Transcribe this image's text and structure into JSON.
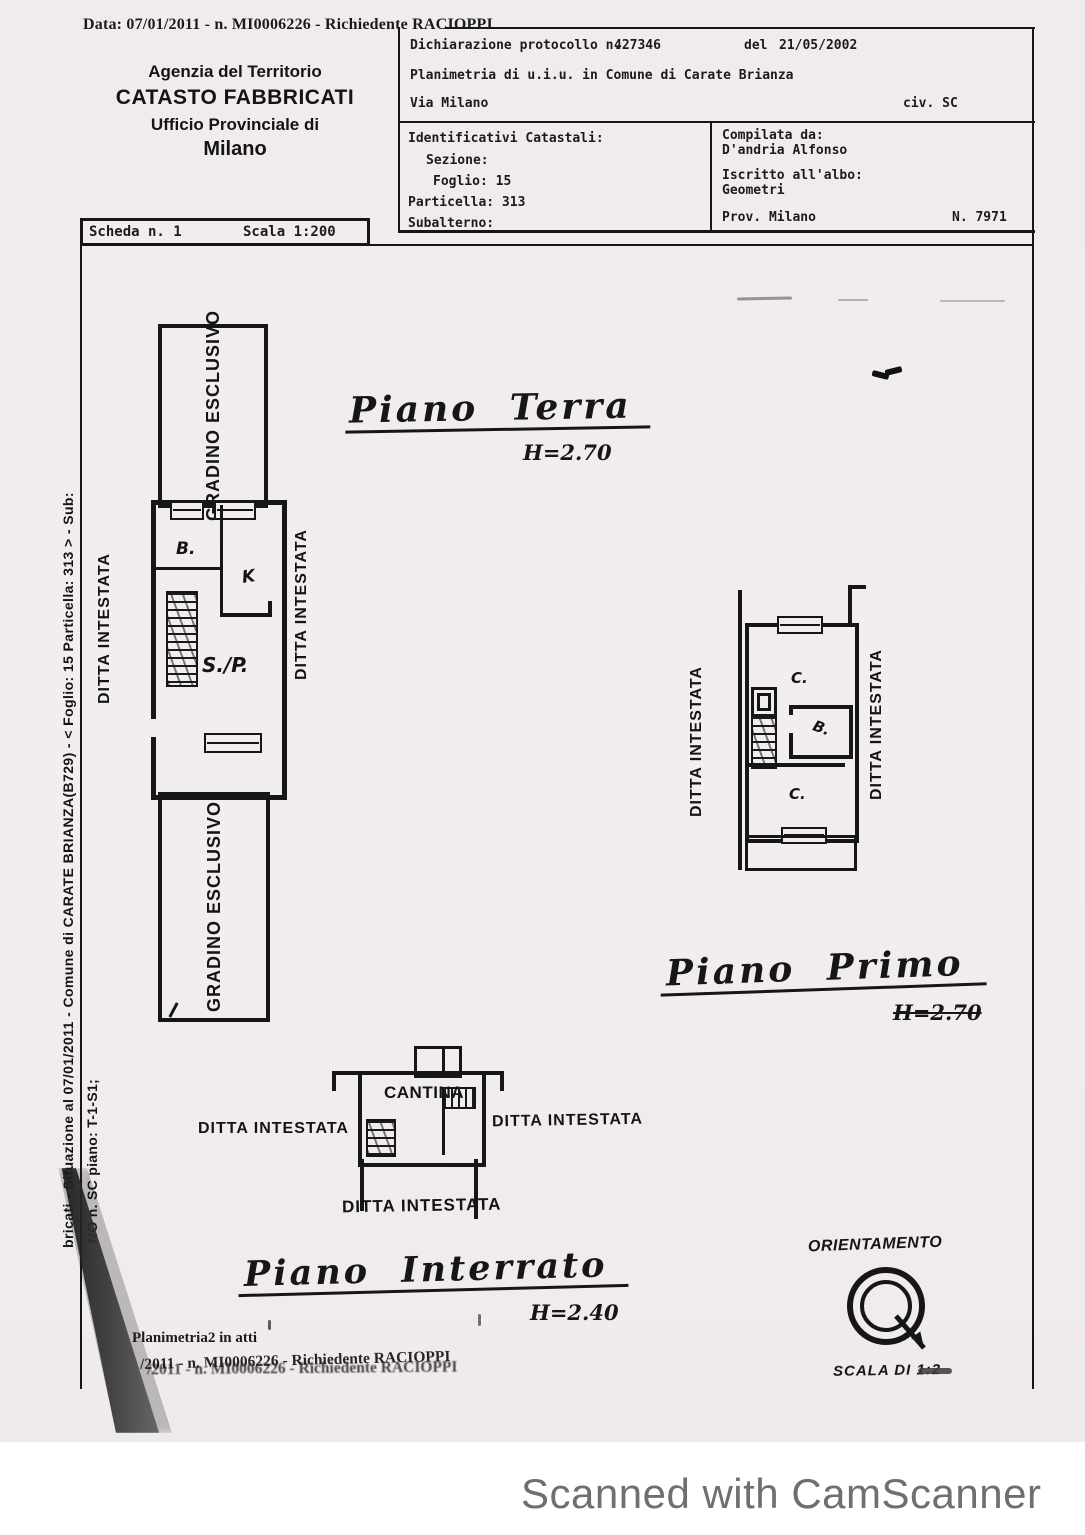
{
  "header": {
    "data_line": "Data: 07/01/2011 - n. MI0006226 - Richiedente RACIOPPI",
    "agency_line1": "Agenzia del Territorio",
    "agency_line2": "CATASTO FABBRICATI",
    "agency_line3": "Ufficio Provinciale di",
    "agency_line4": "Milano",
    "protocol_label": "Dichiarazione protocollo n.",
    "protocol_number": "427346",
    "protocol_del": "del",
    "protocol_date": "21/05/2002",
    "planimetria_line": "Planimetria di u.i.u. in Comune di Carate Brianza",
    "via": "Via Milano",
    "civ": "civ. SC",
    "identificativi_title": "Identificativi Catastali:",
    "sezione": "Sezione:",
    "foglio": "Foglio: 15",
    "particella": "Particella: 313",
    "subalterno": "Subalterno:",
    "compilata_title": "Compilata da:",
    "compilata_name": "D'andria Alfonso",
    "albo_label": "Iscritto all'albo:",
    "albo_value": "Geometri",
    "prov": "Prov. Milano",
    "albo_number": "N. 7971",
    "scheda": "Scheda n. 1",
    "scala": "Scala 1:200"
  },
  "margin": {
    "line1": "bricati - Situazione al 07/01/2011 - Comune di CARATE BRIANZA(B729) - < Foglio: 15 Particella: 313 > - Sub:",
    "line2": "NO n. SC piano: T-1-S1;"
  },
  "labels": {
    "ditta": "DITTA INTESTATA",
    "gradino": "GRADINO ESCLUSIVO"
  },
  "plans": {
    "terra": {
      "title": "Piano Terra",
      "height": "H=2.70",
      "room_b": "B.",
      "room_k": "K",
      "room_sp": "S./P."
    },
    "primo": {
      "title": "Piano Primo",
      "height": "H=2.70",
      "room_c1": "C.",
      "room_b": "B.",
      "room_c2": "C."
    },
    "interrato": {
      "title": "Piano Interrato",
      "height": "H=2.40",
      "room": "CANTINA"
    }
  },
  "footer": {
    "planimetria_atti": "Planimetria2 in atti",
    "ghost_line": "/2011 - n. MI0006226 - Richiedente RACIOPPI",
    "orientamento": "ORIENTAMENTO",
    "scala_di": "SCALA DI 1:2",
    "camscanner": "Scanned with CamScanner"
  },
  "colors": {
    "ink": "#161616",
    "paper": "#f1edef",
    "camscanner_text": "#6f6f6f"
  }
}
